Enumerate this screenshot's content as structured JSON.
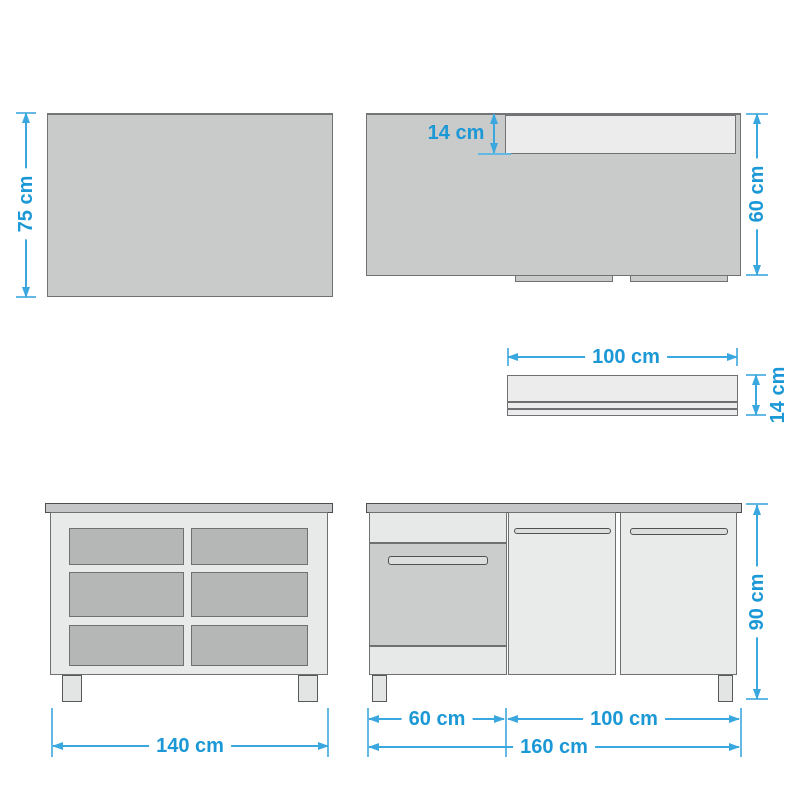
{
  "diagram": {
    "type": "furniture-dimension-drawing",
    "unit": "cm",
    "labels": {
      "wall_panel_height": "75 cm",
      "wall_panel_shelf_depth": "14 cm",
      "wall_panel_right_height": "60 cm",
      "wall_shelf_width": "100 cm",
      "wall_shelf_height": "14 cm",
      "sideboard_width": "140 cm",
      "base_unit_height": "90 cm",
      "base_unit_left_module_width": "60 cm",
      "base_unit_doors_width": "100 cm",
      "base_unit_total_width": "160 cm"
    },
    "colors": {
      "dimension_text": "#1b98d5",
      "dimension_line": "#3aa8de",
      "extension_line": "#63b9e4",
      "panel_fill": "#c9caca",
      "panel_border": "#707174",
      "frame_fill": "#e8e9e9",
      "shelf_fill": "#ececec",
      "compartment_fill": "#b5b6b6",
      "countertop_fill": "#c5c6c7",
      "appliance_fill": "#cbcccc",
      "outline_dark": "#58595b",
      "background": "#ffffff"
    }
  }
}
